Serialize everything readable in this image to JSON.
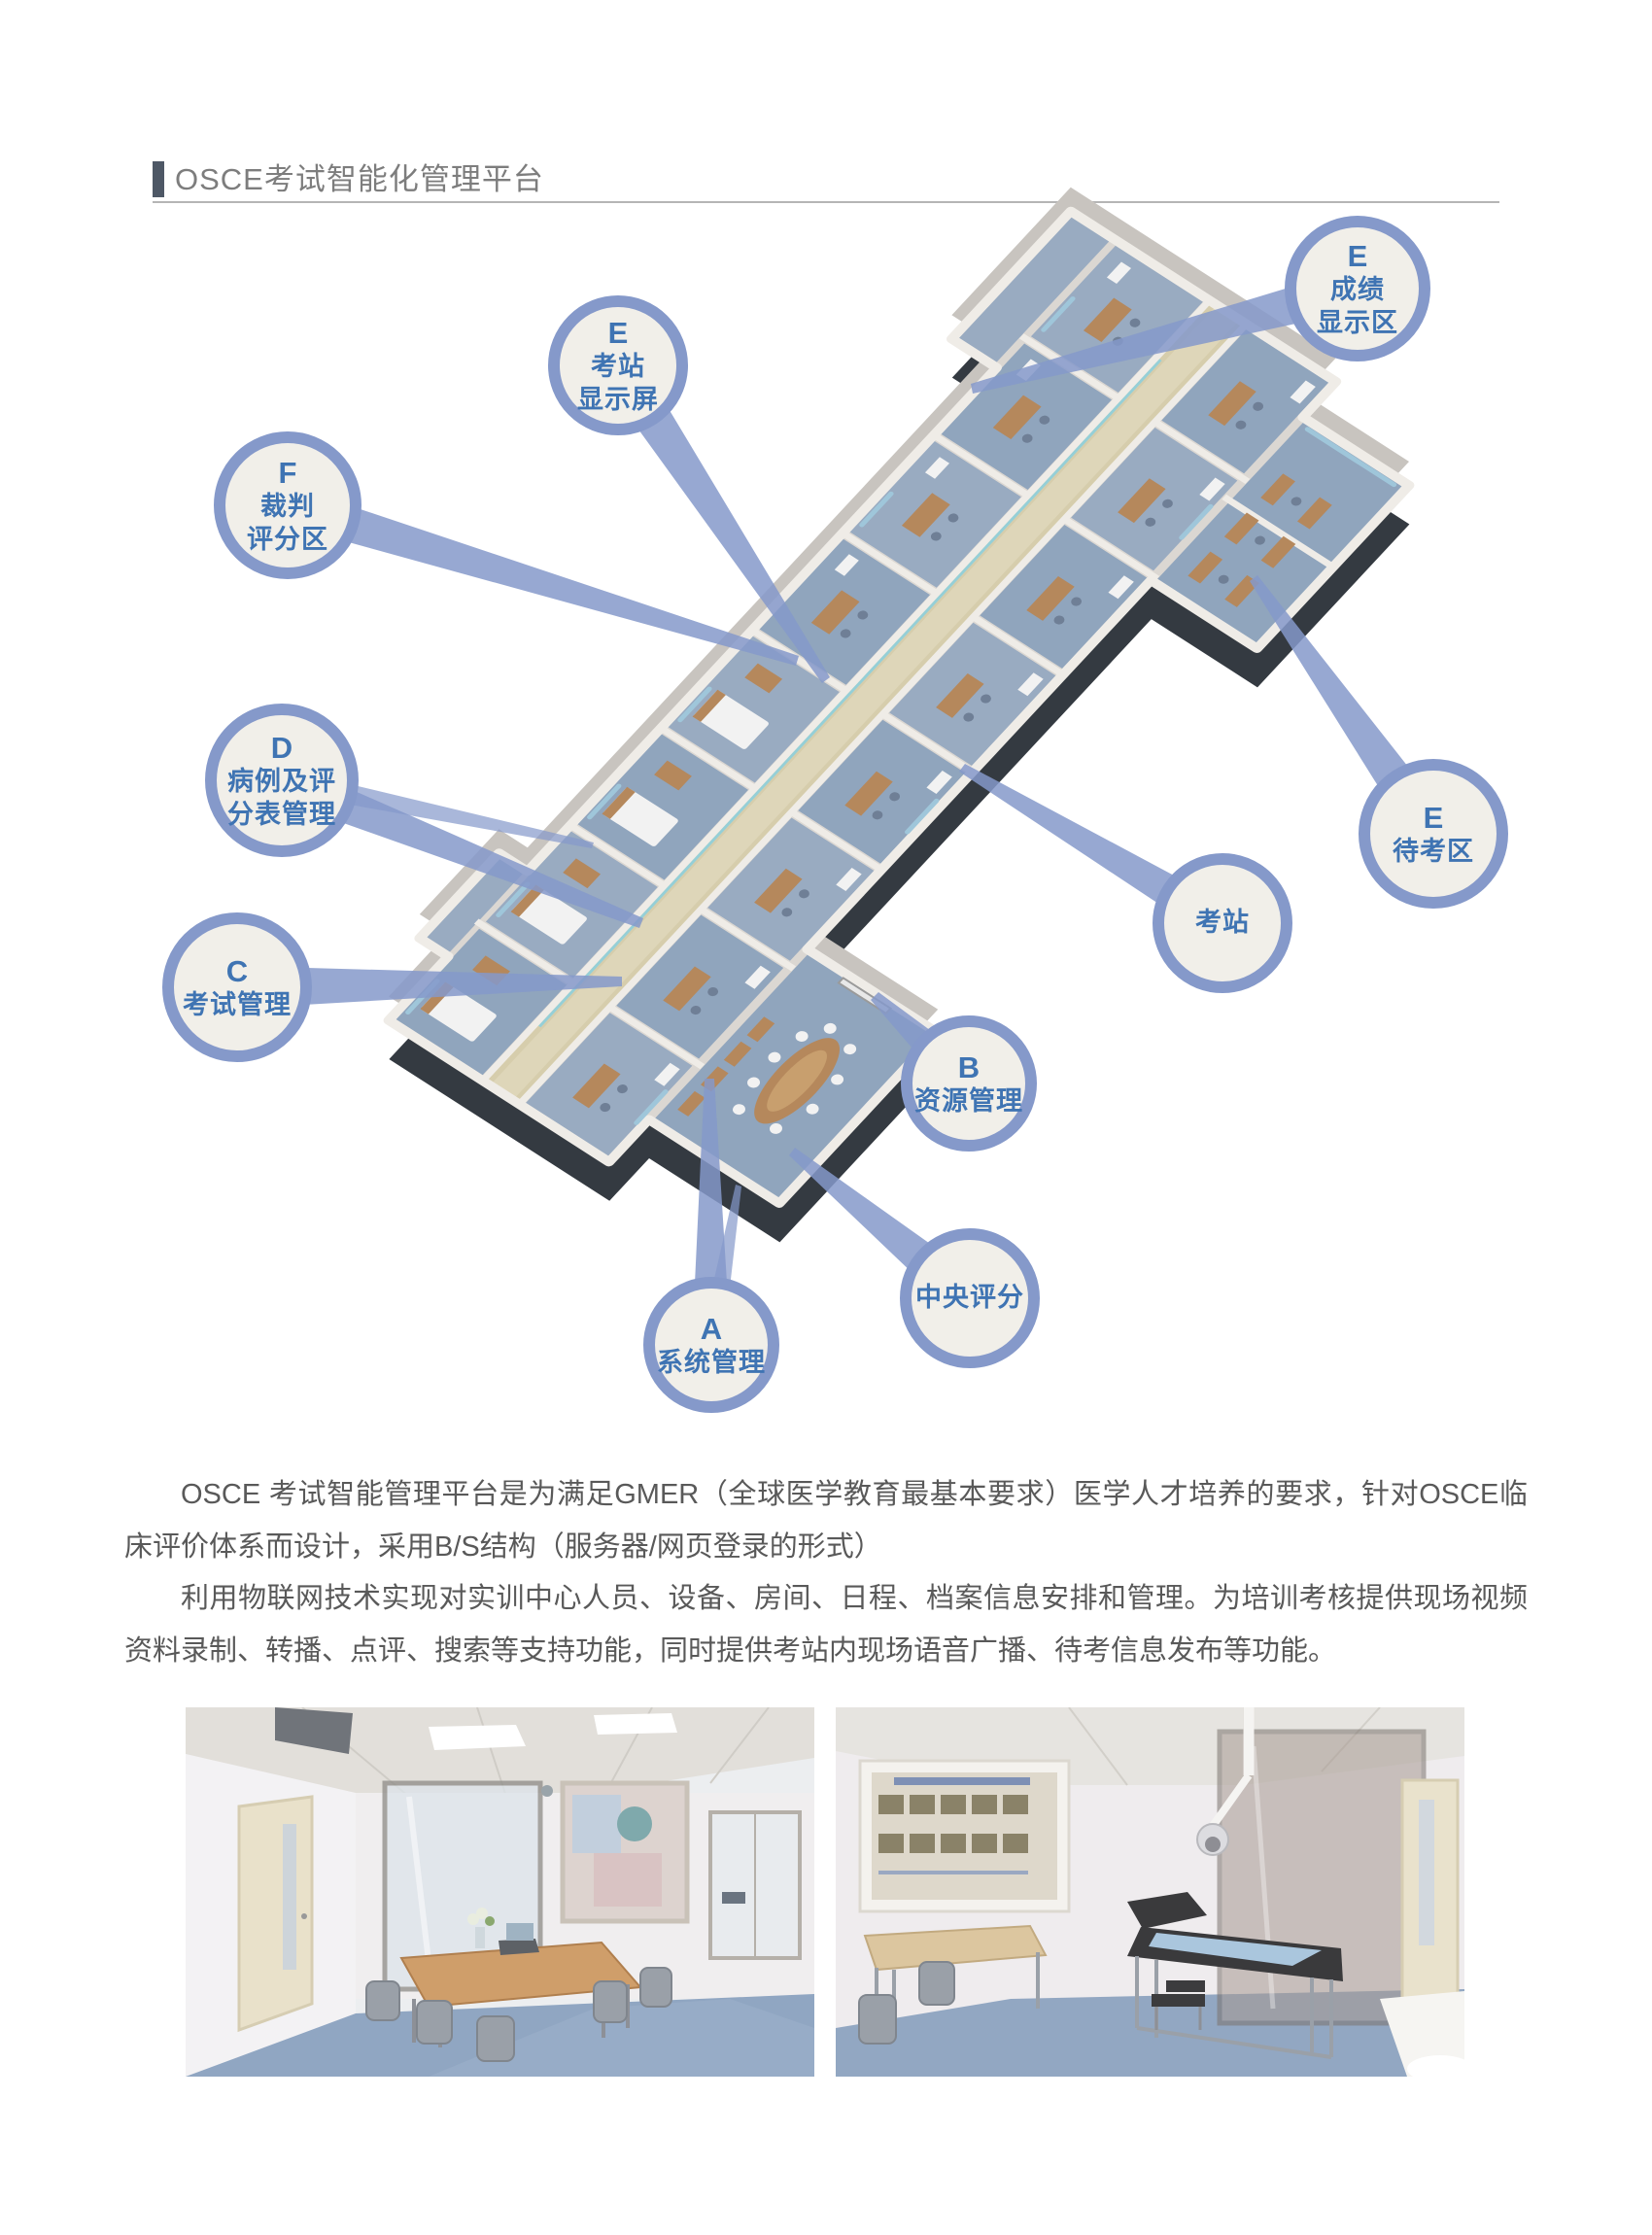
{
  "page": {
    "title": "OSCE考试智能化管理平台"
  },
  "diagram": {
    "bubbles": [
      {
        "id": "score-display-area",
        "letter": "E",
        "lines": [
          "成绩",
          "显示区"
        ]
      },
      {
        "id": "station-display-screen",
        "letter": "E",
        "lines": [
          "考站",
          "显示屏"
        ]
      },
      {
        "id": "judge-scoring-area",
        "letter": "F",
        "lines": [
          "裁判",
          "评分区"
        ]
      },
      {
        "id": "case-and-score-sheet-mgmt",
        "letter": "D",
        "lines": [
          "病例及评",
          "分表管理"
        ]
      },
      {
        "id": "exam-management",
        "letter": "C",
        "lines": [
          "考试管理"
        ]
      },
      {
        "id": "waiting-area",
        "letter": "E",
        "lines": [
          "待考区"
        ]
      },
      {
        "id": "exam-station",
        "lines": [
          "考站"
        ]
      },
      {
        "id": "resource-management",
        "letter": "B",
        "lines": [
          "资源管理"
        ]
      },
      {
        "id": "central-scoring",
        "lines": [
          "中央评分"
        ]
      },
      {
        "id": "system-management",
        "letter": "A",
        "lines": [
          "系统管理"
        ]
      }
    ],
    "colors": {
      "ring": "#8599ca",
      "inner": "#f1efe9",
      "btext": "#3f74b3",
      "beam": "#8599ca",
      "bar": "#4e5866",
      "title": "#7d7d7d",
      "body": "#595959"
    }
  },
  "paragraphs": [
    "OSCE 考试智能管理平台是为满足GMER（全球医学教育最基本要求）医学人才培养的要求，针对OSCE临床评价体系而设计，采用B/S结构（服务器/网页登录的形式）",
    "利用物联网技术实现对实训中心人员、设备、房间、日程、档案信息安排和管理。为培训考核提供现场视频资料录制、转播、点评、搜索等支持功能，同时提供考站内现场语音广播、待考信息发布等功能。"
  ]
}
